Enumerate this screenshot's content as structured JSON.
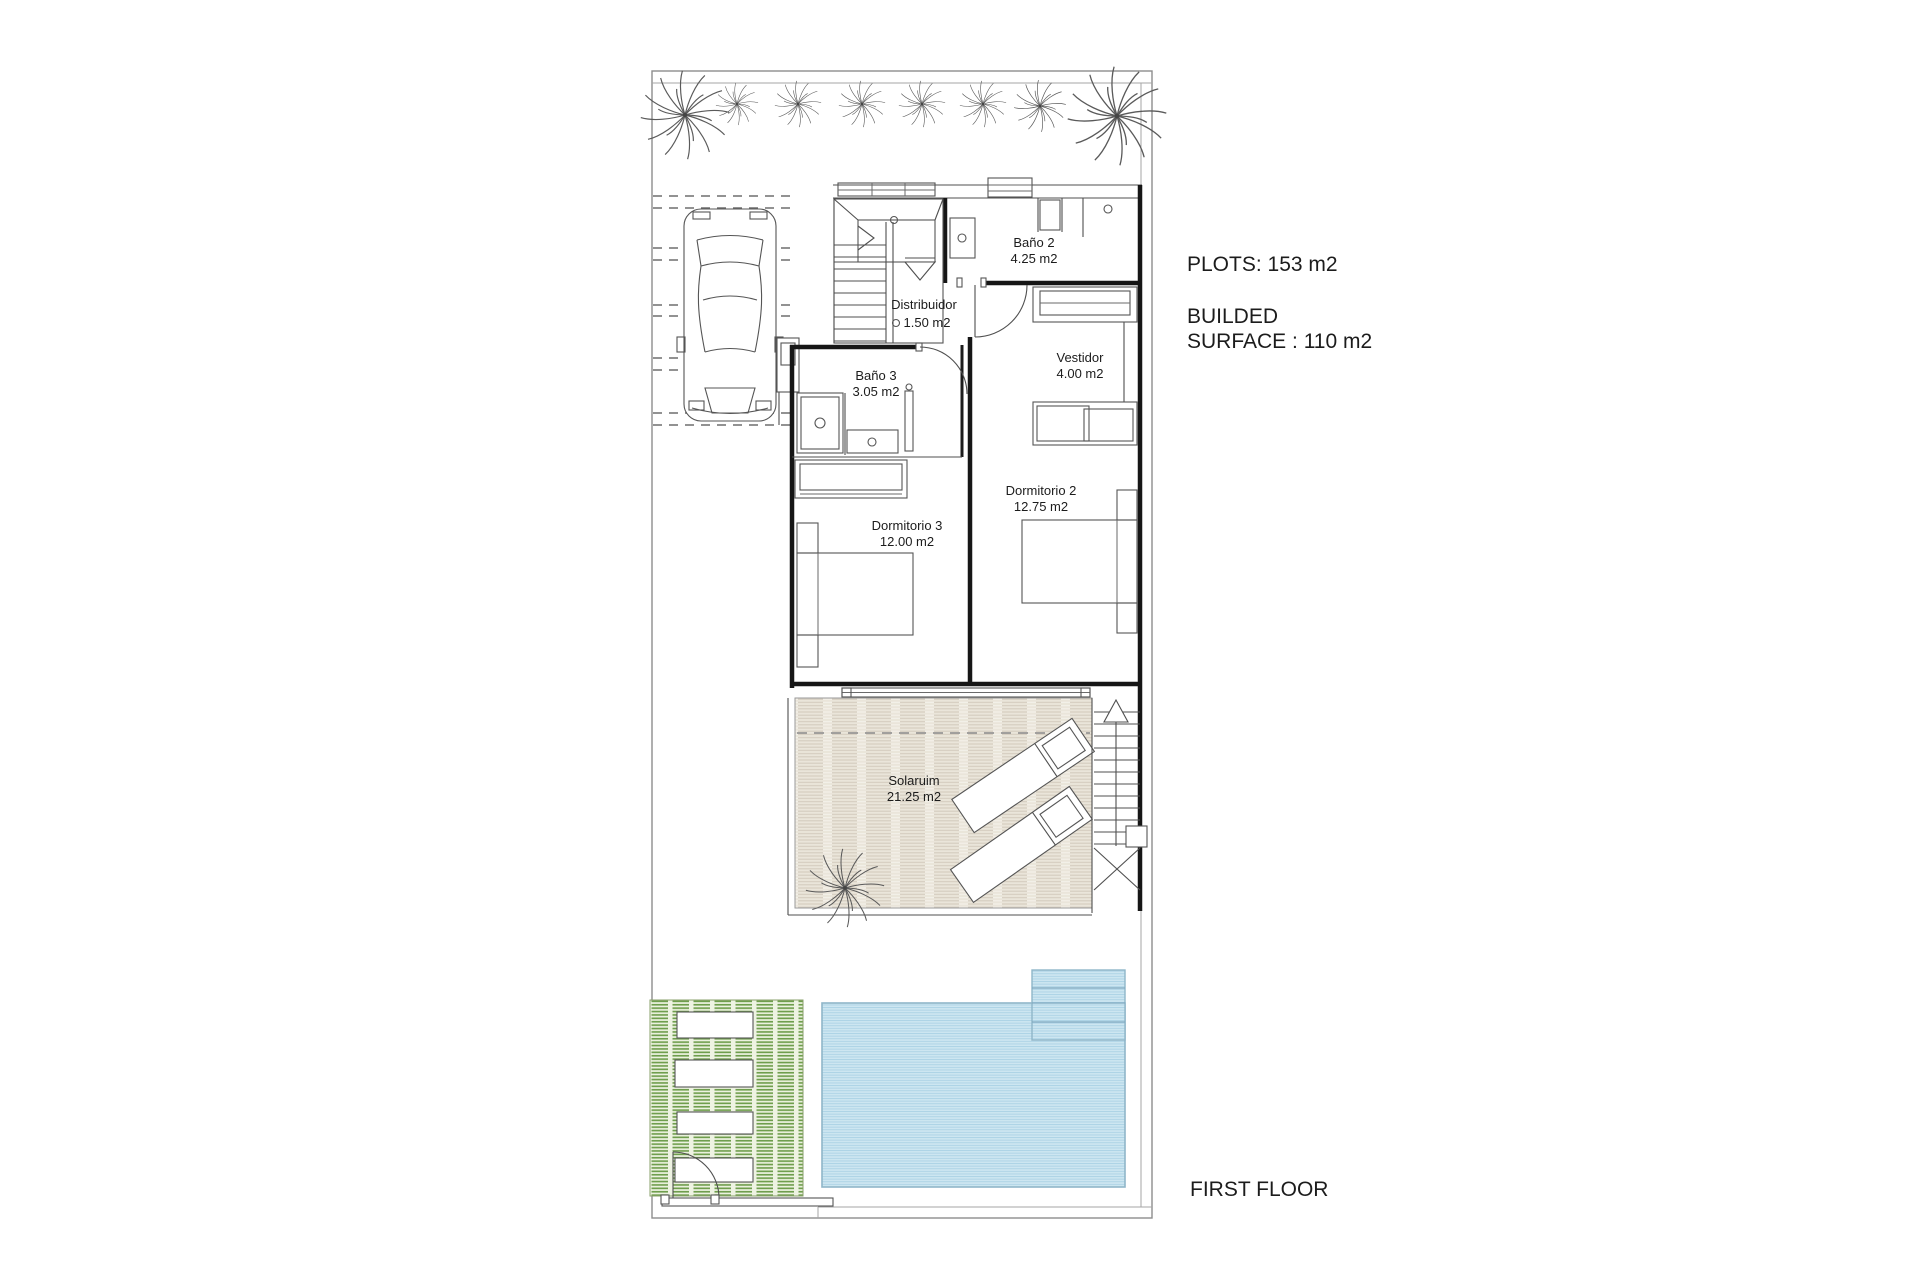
{
  "plan": {
    "rooms": [
      {
        "name": "Baño 2",
        "area": "4.25 m2"
      },
      {
        "name": "Distribuidor",
        "area": "1.50 m2"
      },
      {
        "name": "Baño 3",
        "area": "3.05 m2"
      },
      {
        "name": "Vestidor",
        "area": "4.00 m2"
      },
      {
        "name": "Dormitorio 2",
        "area": "12.75 m2"
      },
      {
        "name": "Dormitorio 3",
        "area": "12.00 m2"
      },
      {
        "name": "Solaruim",
        "area": "21.25 m2"
      }
    ],
    "annotations": {
      "plots": "PLOTS: 153 m2",
      "builded_line1": "BUILDED",
      "builded_line2": "SURFACE : 110 m2",
      "floor_label": "FIRST FLOOR"
    },
    "colors": {
      "pool_base": "#cde6f1",
      "pool_stripe": "#abd2e4",
      "pool_border": "#8fb6c9",
      "deck_base": "#eef3e2",
      "deck_stripe": "#6f9e4d",
      "solarium_base": "#eae5da",
      "solarium_stripe": "#d6cec0"
    }
  }
}
